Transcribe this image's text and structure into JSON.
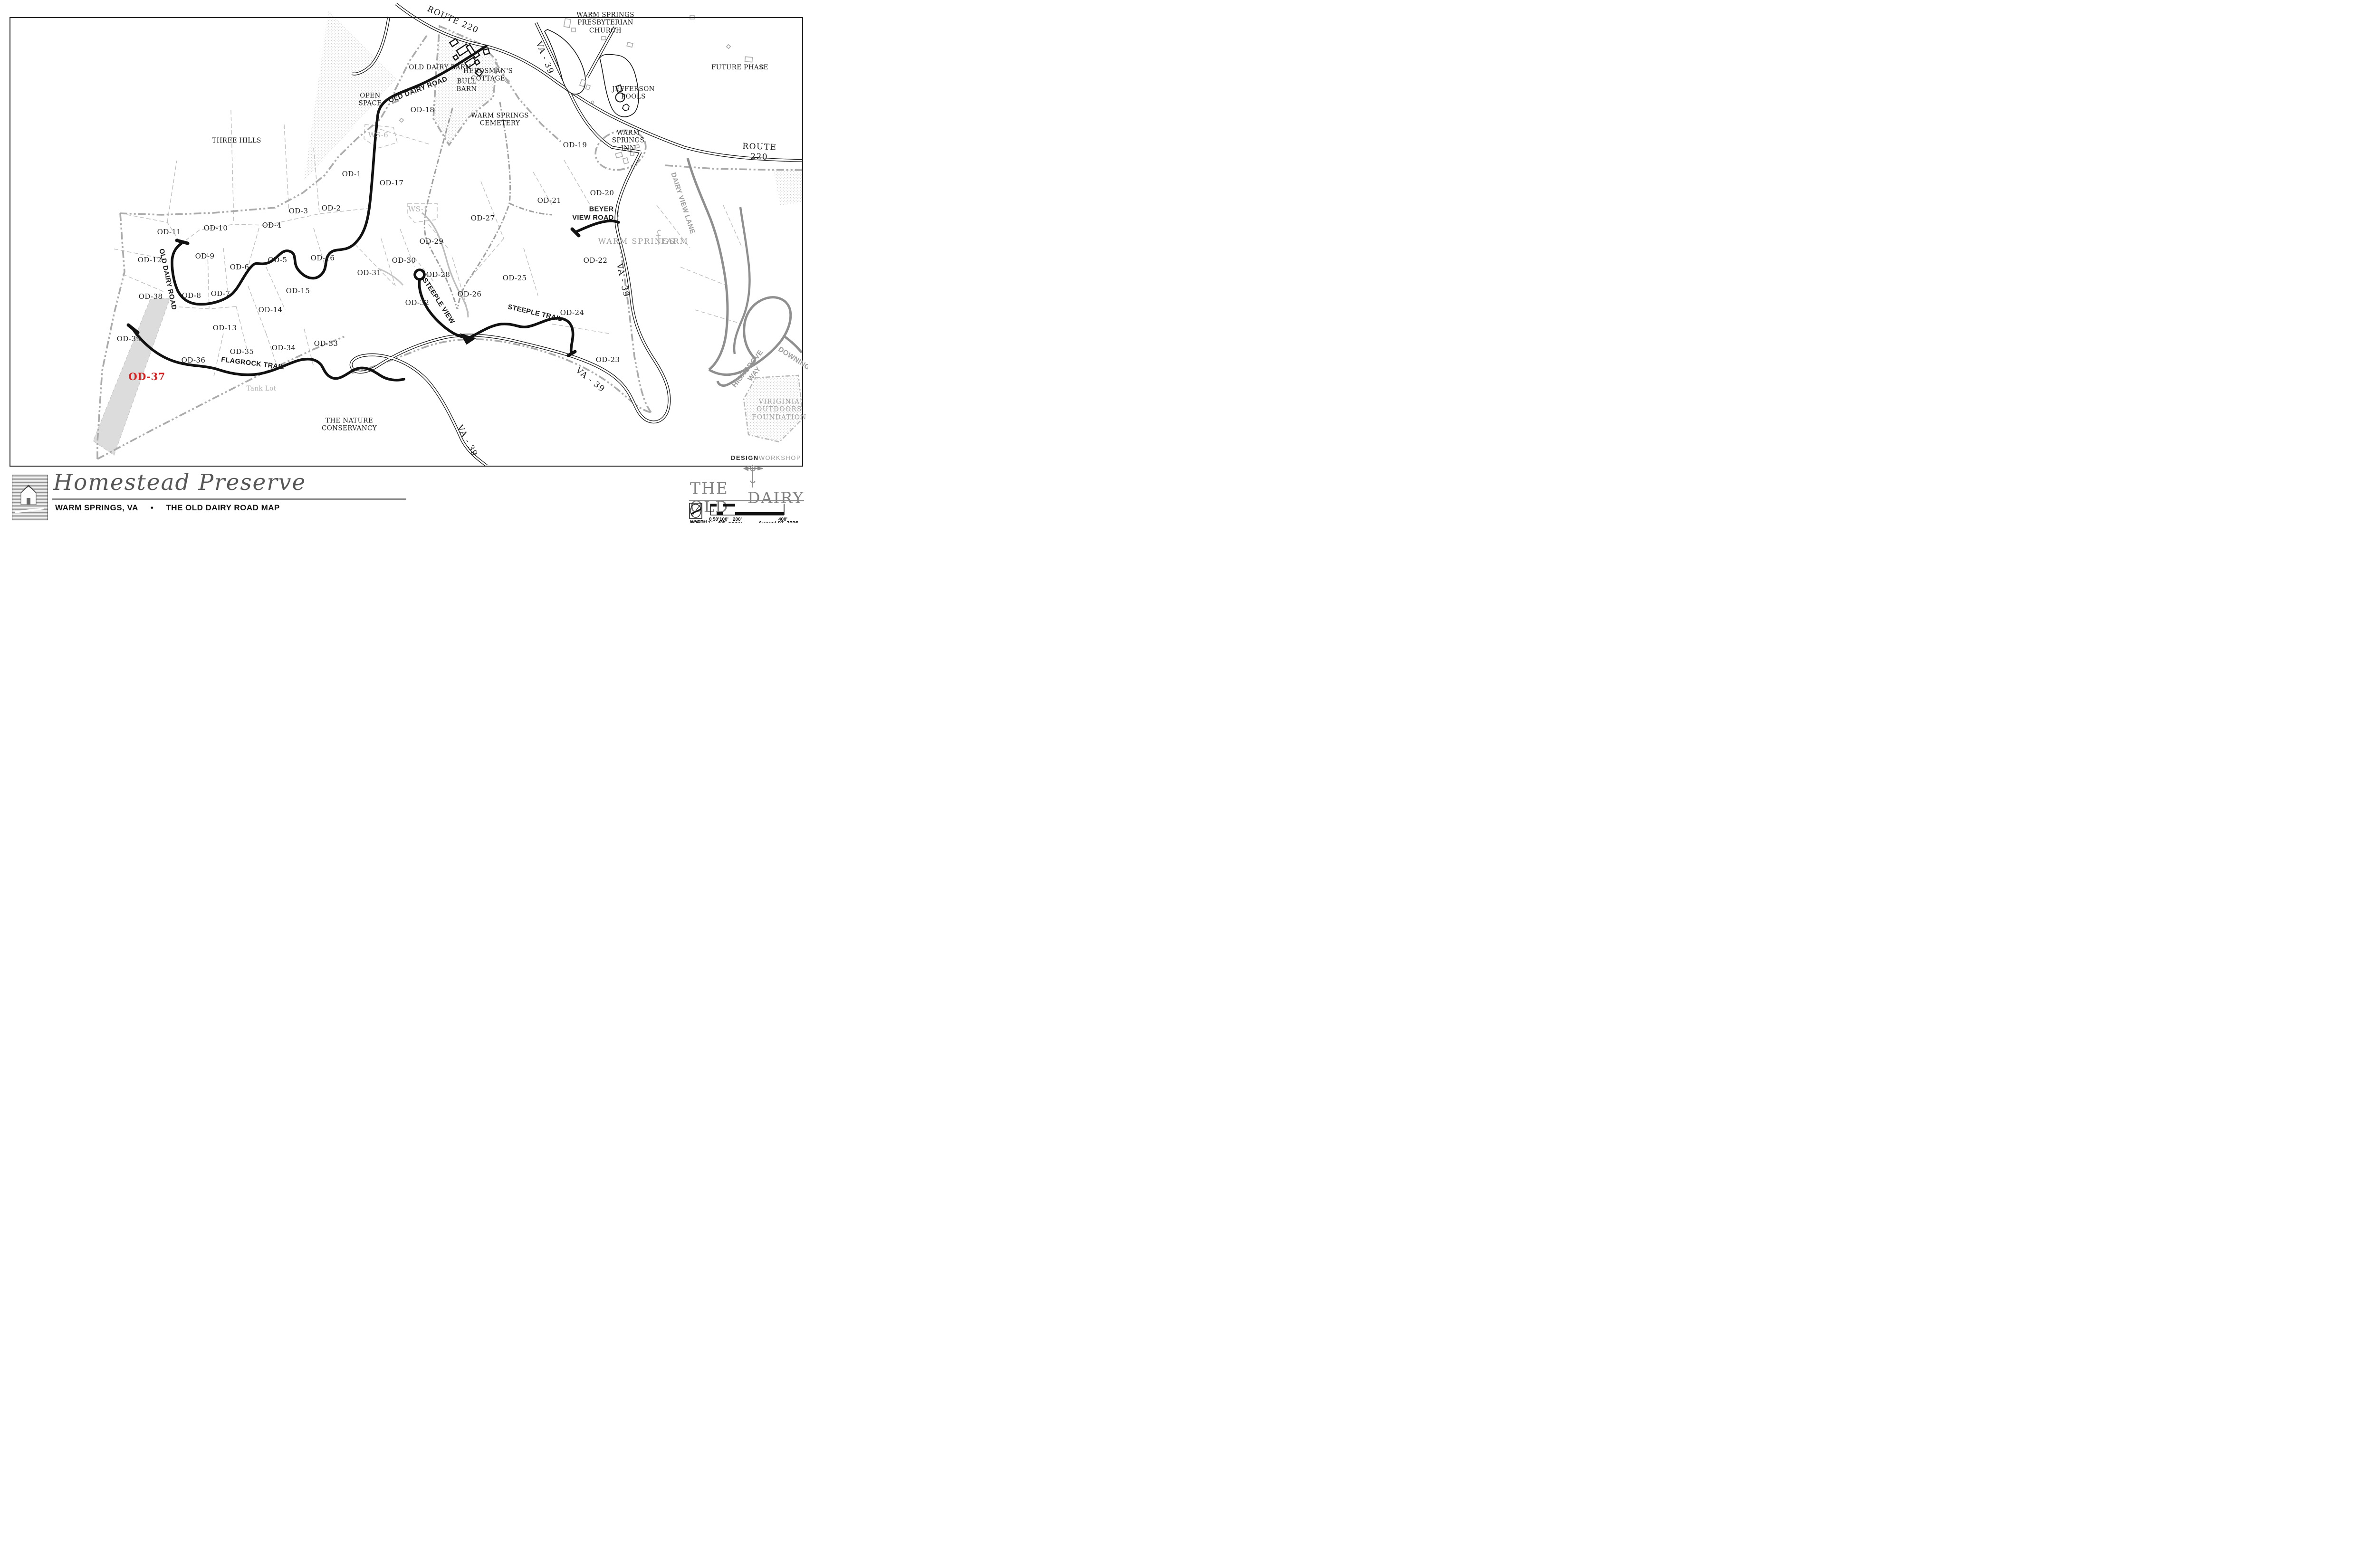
{
  "title_block": {
    "project": "Homestead Preserve",
    "location": "WARM SPRINGS, VA",
    "separator": "•",
    "map_name": "THE OLD DAIRY ROAD MAP",
    "brand_left": "THE OLD",
    "brand_right": "DAIRY",
    "credit_bold": "DESIGN",
    "credit_light": "WORKSHOP",
    "north_label": "NORTH",
    "scale_label": "SCALE:  1\" = 400' approx.",
    "scale_ticks": [
      "0",
      "50'",
      "100'",
      "200'",
      "400'"
    ],
    "date": "August 07, 2006"
  },
  "roads": {
    "route_220": "ROUTE 220",
    "va_39": "VA - 39",
    "old_dairy_road": "OLD DAIRY ROAD",
    "flagrock_trail": "FLAGROCK TRAIL",
    "steeple_view": "STEEPLE VIEW",
    "steeple_trail": "STEEPLE TRAIL",
    "beyer_view_road": "BEYER\nVIEW ROAD",
    "dairy_view_lane": "DAIRY VIEW LANE",
    "highgrove_way": "HIGHGROVE WAY",
    "downing": "DOWNING"
  },
  "places": {
    "presbyterian_church": "WARM SPRINGS\nPRESBYTERIAN\nCHURCH",
    "old_dairy_barn": "OLD DAIRY BARN",
    "herdsmans_cottage": "HERDSMAN'S\nCOTTAGE",
    "bull_barn": "BULL\nBARN",
    "open_space": "OPEN\nSPACE",
    "warm_springs_cemetery": "WARM SPRINGS\nCEMETERY",
    "jefferson_pools": "JEFFERSON\nPOOLS",
    "future_phase": "FUTURE PHASE",
    "warm_springs_inn": "WARM\nSPRINGS\nINN",
    "three_hills": "THREE HILLS",
    "warm_springs_farm_left": "WARM SPRINGS",
    "warm_springs_farm_right": "FARM",
    "tank_lot": "Tank Lot",
    "nature_conservancy": "THE NATURE\nCONSERVANCY",
    "outdoors_foundation": "VIRIGINIA\nOUTDOORS\nFOUNDATION"
  },
  "parcels": {
    "od1": "OD-1",
    "od2": "OD-2",
    "od3": "OD-3",
    "od4": "OD-4",
    "od5": "OD-5",
    "od6": "OD-6",
    "od7": "OD-7",
    "od8": "OD-8",
    "od9": "OD-9",
    "od10": "OD-10",
    "od11": "OD-11",
    "od12": "OD-12",
    "od13": "OD-13",
    "od14": "OD-14",
    "od15": "OD-15",
    "od16": "OD-16",
    "od17": "OD-17",
    "od18": "OD-18",
    "od19": "OD-19",
    "od20": "OD-20",
    "od21": "OD-21",
    "od22": "OD-22",
    "od23": "OD-23",
    "od24": "OD-24",
    "od25": "OD-25",
    "od26": "OD-26",
    "od27": "OD-27",
    "od28": "OD-28",
    "od29": "OD-29",
    "od30": "OD-30",
    "od31": "OD-31",
    "od32": "OD-32",
    "od33": "OD-33",
    "od34": "OD-34",
    "od35": "OD-35",
    "od36": "OD-36",
    "od37": "OD-37",
    "od38": "OD-38",
    "od39": "OD-39",
    "ws6": "WS-6",
    "ws1": "WS-1"
  }
}
